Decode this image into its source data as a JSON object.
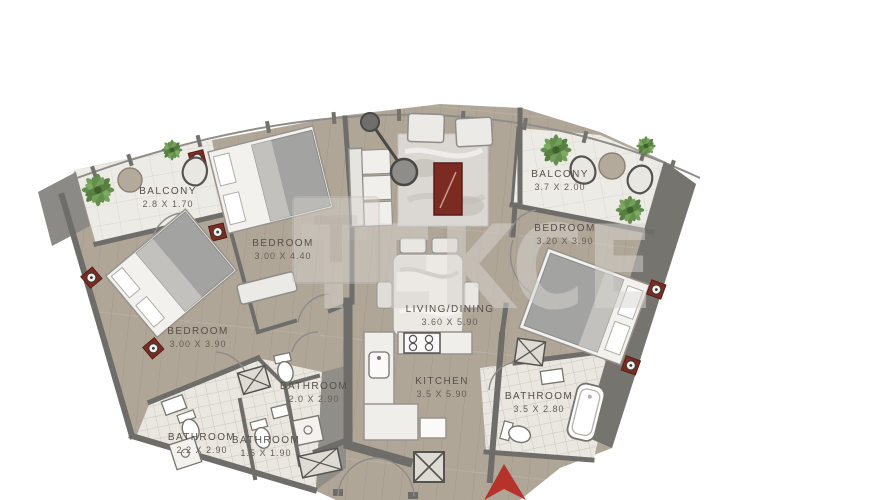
{
  "plan": {
    "type": "apartment-floor-plan",
    "watermark": {
      "brand": "TEKCE",
      "logo_letter": "T"
    },
    "rooms": [
      {
        "id": "balcony-left",
        "name": "BALCONY",
        "dims": "2.8 X 1.70"
      },
      {
        "id": "bedroom-1",
        "name": "BEDROOM",
        "dims": "3.00 X 4.40"
      },
      {
        "id": "bedroom-2",
        "name": "BEDROOM",
        "dims": "3.00 X 3.90"
      },
      {
        "id": "living-dining",
        "name": "LIVING/DINING",
        "dims": "3.60 X 5.90"
      },
      {
        "id": "kitchen",
        "name": "KITCHEN",
        "dims": "3.5 X 5.90"
      },
      {
        "id": "balcony-right",
        "name": "BALCONY",
        "dims": "3.7 X 2.00"
      },
      {
        "id": "bedroom-3",
        "name": "BEDROOM",
        "dims": "3.20 X 3.90"
      },
      {
        "id": "bathroom-1",
        "name": "BATHROOM",
        "dims": "2.2 X 2.90"
      },
      {
        "id": "bathroom-2",
        "name": "BATHROOM",
        "dims": "1.5 X 1.90"
      },
      {
        "id": "bathroom-3",
        "name": "BATHROOM",
        "dims": "2.0 X 2.90"
      },
      {
        "id": "bathroom-4",
        "name": "BATHROOM",
        "dims": "3.5 X 2.80"
      }
    ],
    "colors": {
      "floor_wood": "#b0a698",
      "wall_dark": "#6e6d69",
      "balcony_tile": "#edebe6",
      "bathroom_tile": "#eae7e1",
      "accent_red_furniture": "#7c2b22",
      "entrance_arrow_red": "#b5332a",
      "plant_green": "#5d8a45",
      "watermark_gray": "#d8d5d1"
    }
  }
}
